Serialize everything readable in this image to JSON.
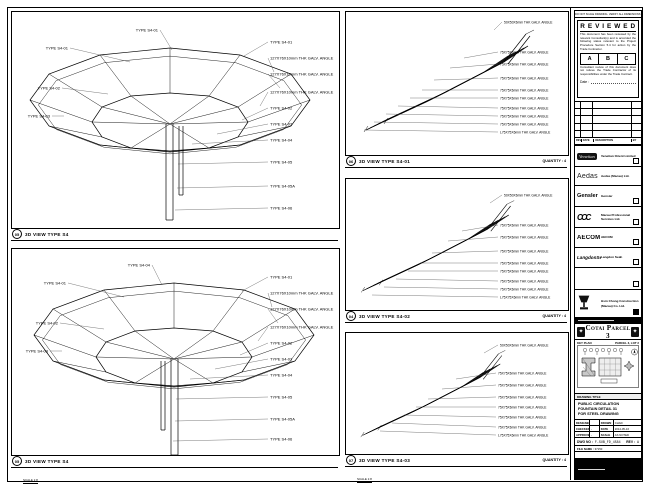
{
  "panels": [
    {
      "key": "tl",
      "num": "05",
      "title": "3D VIEW TYPE S4",
      "scale": "SCALE 1:8",
      "quantity": "",
      "callouts": [
        {
          "t": "TYPE S4-01",
          "a": "end",
          "p": [
            [
              160,
              38
            ],
            [
              148,
              18
            ]
          ]
        },
        {
          "t": "TYPE S4-01",
          "a": "end",
          "p": [
            [
              118,
              50
            ],
            [
              58,
              36
            ]
          ]
        },
        {
          "t": "TYPE S4-02",
          "a": "end",
          "p": [
            [
              96,
              82
            ],
            [
              50,
              76
            ]
          ]
        },
        {
          "t": "TYPE S4-03",
          "a": "end",
          "p": [
            [
              52,
              104
            ],
            [
              40,
              104
            ]
          ]
        },
        {
          "t": "TYPE S4-01",
          "a": "start",
          "p": [
            [
              232,
              44
            ],
            [
              256,
              30
            ]
          ]
        },
        {
          "t": "127X76X10mm THK GALV. ANGLE",
          "a": "start",
          "p": [
            [
              262,
              60
            ],
            [
              256,
              46
            ]
          ]
        },
        {
          "t": "127X76X10mm THK GALV. ANGLE",
          "a": "start",
          "p": [
            [
              268,
              76
            ],
            [
              256,
              62
            ]
          ]
        },
        {
          "t": "127X76X10mm THK GALV. ANGLE",
          "a": "start",
          "p": [
            [
              248,
              94
            ],
            [
              256,
              80
            ]
          ]
        },
        {
          "t": "TYPE S4-02",
          "a": "start",
          "p": [
            [
              230,
              108
            ],
            [
              256,
              96
            ]
          ]
        },
        {
          "t": "TYPE S4-03",
          "a": "start",
          "p": [
            [
              205,
              122
            ],
            [
              256,
              112
            ]
          ]
        },
        {
          "t": "TYPE S4-04",
          "a": "start",
          "p": [
            [
              180,
              132
            ],
            [
              256,
              128
            ]
          ]
        },
        {
          "t": "TYPE S4-05",
          "a": "start",
          "p": [
            [
              166,
              152
            ],
            [
              256,
              150
            ]
          ]
        },
        {
          "t": "TYPE S4-05A",
          "a": "start",
          "p": [
            [
              165,
              176
            ],
            [
              256,
              174
            ]
          ]
        },
        {
          "t": "TYPE S4-06",
          "a": "start",
          "p": [
            [
              163,
              198
            ],
            [
              256,
              196
            ]
          ]
        }
      ]
    },
    {
      "key": "bl",
      "num": "05",
      "title": "3D VIEW TYPE S4",
      "scale": "SCALE 1:8",
      "quantity": "",
      "callouts": [
        {
          "t": "TYPE S4-04",
          "a": "end",
          "p": [
            [
              150,
              36
            ],
            [
              140,
              16
            ]
          ]
        },
        {
          "t": "TYPE S4-01",
          "a": "end",
          "p": [
            [
              112,
              48
            ],
            [
              56,
              34
            ]
          ]
        },
        {
          "t": "TYPE S4-02",
          "a": "end",
          "p": [
            [
              92,
              80
            ],
            [
              48,
              74
            ]
          ]
        },
        {
          "t": "TYPE S4-03",
          "a": "end",
          "p": [
            [
              50,
              102
            ],
            [
              38,
              102
            ]
          ]
        },
        {
          "t": "TYPE S4-01",
          "a": "start",
          "p": [
            [
              230,
              42
            ],
            [
              256,
              28
            ]
          ]
        },
        {
          "t": "127X76X10mm THK GALV. ANGLE",
          "a": "start",
          "p": [
            [
              260,
              58
            ],
            [
              256,
              44
            ]
          ]
        },
        {
          "t": "127X76X10mm THK GALV. ANGLE",
          "a": "start",
          "p": [
            [
              266,
              74
            ],
            [
              256,
              60
            ]
          ]
        },
        {
          "t": "127X76X10mm THK GALV. ANGLE",
          "a": "start",
          "p": [
            [
              246,
              92
            ],
            [
              256,
              78
            ]
          ]
        },
        {
          "t": "TYPE S4-02",
          "a": "start",
          "p": [
            [
              228,
              106
            ],
            [
              256,
              94
            ]
          ]
        },
        {
          "t": "TYPE S4-03",
          "a": "start",
          "p": [
            [
              203,
              120
            ],
            [
              256,
              110
            ]
          ]
        },
        {
          "t": "TYPE S4-04",
          "a": "start",
          "p": [
            [
              178,
              130
            ],
            [
              256,
              126
            ]
          ]
        },
        {
          "t": "TYPE S4-05",
          "a": "start",
          "p": [
            [
              164,
              150
            ],
            [
              256,
              148
            ]
          ]
        },
        {
          "t": "TYPE S4-05A",
          "a": "start",
          "p": [
            [
              163,
              172
            ],
            [
              256,
              170
            ]
          ]
        },
        {
          "t": "TYPE S4-06",
          "a": "start",
          "p": [
            [
              161,
              192
            ],
            [
              256,
              190
            ]
          ]
        }
      ]
    },
    {
      "key": "m1",
      "num": "06",
      "title": "3D VIEW TYPE S4-01",
      "scale": "SCALE 1:8",
      "quantity": "QUANTITY : 4",
      "callouts": [
        {
          "t": "50X50X6mm THK GALV. ANGLE",
          "a": "start",
          "p": [
            [
              148,
              18
            ],
            [
              156,
              10
            ]
          ]
        },
        {
          "t": "75X75X6mm THK GALV. ANGLE",
          "a": "start",
          "p": [
            [
              118,
              46
            ],
            [
              152,
              40
            ]
          ]
        },
        {
          "t": "75X75X6mm THK GALV. ANGLE",
          "a": "start",
          "p": [
            [
              104,
              56
            ],
            [
              152,
              52
            ]
          ]
        },
        {
          "t": "75X75X6mm THK GALV. ANGLE",
          "a": "start",
          "p": [
            [
              88,
              68
            ],
            [
              152,
              66
            ]
          ]
        },
        {
          "t": "75X75X6mm THK GALV. ANGLE",
          "a": "start",
          "p": [
            [
              76,
              78
            ],
            [
              152,
              78
            ]
          ]
        },
        {
          "t": "75X75X6mm THK GALV. ANGLE",
          "a": "start",
          "p": [
            [
              64,
              86
            ],
            [
              152,
              86
            ]
          ]
        },
        {
          "t": "75X75X6mm THK GALV. ANGLE",
          "a": "start",
          "p": [
            [
              52,
              94
            ],
            [
              152,
              96
            ]
          ]
        },
        {
          "t": "75X75X6mm THK GALV. ANGLE",
          "a": "start",
          "p": [
            [
              40,
              102
            ],
            [
              152,
              104
            ]
          ]
        },
        {
          "t": "75X75X6mm THK GALV. ANGLE",
          "a": "start",
          "p": [
            [
              28,
              110
            ],
            [
              152,
              112
            ]
          ]
        },
        {
          "t": "L75X75X6mm THK GALV. ANGLE",
          "a": "start",
          "p": [
            [
              18,
              118
            ],
            [
              152,
              120
            ]
          ]
        }
      ]
    },
    {
      "key": "m2",
      "num": "04",
      "title": "3D VIEW TYPE S4-02",
      "scale": "SCALE 1:8",
      "quantity": "QUANTITY : 4",
      "callouts": [
        {
          "t": "50X50X6mm THK GALV. ANGLE",
          "a": "start",
          "p": [
            [
              144,
              24
            ],
            [
              156,
              16
            ]
          ]
        },
        {
          "t": "75X75X6mm THK GALV. ANGLE",
          "a": "start",
          "p": [
            [
              116,
              52
            ],
            [
              152,
              46
            ]
          ]
        },
        {
          "t": "75X75X6mm THK GALV. ANGLE",
          "a": "start",
          "p": [
            [
              102,
              62
            ],
            [
              152,
              58
            ]
          ]
        },
        {
          "t": "75X75X6mm THK GALV. ANGLE",
          "a": "start",
          "p": [
            [
              86,
              74
            ],
            [
              152,
              72
            ]
          ]
        },
        {
          "t": "75X75X6mm THK GALV. ANGLE",
          "a": "start",
          "p": [
            [
              74,
              84
            ],
            [
              152,
              84
            ]
          ]
        },
        {
          "t": "75X75X6mm THK GALV. ANGLE",
          "a": "start",
          "p": [
            [
              62,
              92
            ],
            [
              152,
              92
            ]
          ]
        },
        {
          "t": "75X75X6mm THK GALV. ANGLE",
          "a": "start",
          "p": [
            [
              50,
              100
            ],
            [
              152,
              102
            ]
          ]
        },
        {
          "t": "75X75X6mm THK GALV. ANGLE",
          "a": "start",
          "p": [
            [
              38,
              108
            ],
            [
              152,
              110
            ]
          ]
        },
        {
          "t": "L75X75X6mm THK GALV. ANGLE",
          "a": "start",
          "p": [
            [
              26,
              116
            ],
            [
              152,
              118
            ]
          ]
        }
      ]
    },
    {
      "key": "m3",
      "num": "07",
      "title": "3D VIEW TYPE S4-03",
      "scale": "SCALE 1:8",
      "quantity": "QUANTITY : 4",
      "callouts": [
        {
          "t": "50X50X6mm THK GALV. ANGLE",
          "a": "start",
          "p": [
            [
              138,
              20
            ],
            [
              152,
              12
            ]
          ]
        },
        {
          "t": "75X75X6mm THK GALV. ANGLE",
          "a": "start",
          "p": [
            [
              110,
              46
            ],
            [
              150,
              40
            ]
          ]
        },
        {
          "t": "75X75X6mm THK GALV. ANGLE",
          "a": "start",
          "p": [
            [
              96,
              56
            ],
            [
              150,
              52
            ]
          ]
        },
        {
          "t": "75X75X6mm THK GALV. ANGLE",
          "a": "start",
          "p": [
            [
              82,
              66
            ],
            [
              150,
              64
            ]
          ]
        },
        {
          "t": "75X75X6mm THK GALV. ANGLE",
          "a": "start",
          "p": [
            [
              70,
              74
            ],
            [
              150,
              74
            ]
          ]
        },
        {
          "t": "75X75X6mm THK GALV. ANGLE",
          "a": "start",
          "p": [
            [
              58,
              82
            ],
            [
              150,
              84
            ]
          ]
        },
        {
          "t": "75X75X6mm THK GALV. ANGLE",
          "a": "start",
          "p": [
            [
              46,
              90
            ],
            [
              150,
              94
            ]
          ]
        },
        {
          "t": "L75X75X6mm THK GALV. ANGLE",
          "a": "start",
          "p": [
            [
              34,
              98
            ],
            [
              150,
              102
            ]
          ]
        }
      ]
    }
  ],
  "stamp": {
    "note": "DO NOT SCALE DRAWING. VERIFY ALL DIMENSIONS ON SITE.",
    "title": "R E V I E W E D",
    "para1": "This document has been reviewed by the relevant Consultant(s) and is accorded the following status relevant to the Project Procedure Section 5.4 for action by the Trade Contractor.",
    "grades": [
      "A",
      "B",
      "C"
    ],
    "para2": "Consultant review of this document does not relieve the Trade Contractor of its responsibilities under the Trade Contract.",
    "date_label": "Date :"
  },
  "rev_table": {
    "headers": [
      "REV",
      "DATE",
      "DESCRIPTION",
      "BY"
    ]
  },
  "consultants": [
    {
      "logo": "Venetian",
      "name": "Venetian Orient Limited"
    },
    {
      "logo": "Aedas",
      "name": "Aedas (Macau) Ltd."
    },
    {
      "logo": "Gensler",
      "name": "Gensler"
    },
    {
      "logo": "CCC",
      "name": "Macau Professional Services Ltd."
    },
    {
      "logo": "AECOM",
      "name": "AECOM"
    },
    {
      "logo": "LangdonSeah",
      "name": "Langdon Seah"
    }
  ],
  "contractor": {
    "name": "Hsin Chong Construction (Macau) Co. Ltd."
  },
  "project": {
    "banner": "Cotai Parcel 3",
    "keyplan_label": "KEY PLAN",
    "parcel_label": "PARCEL 3, LOT 2"
  },
  "titleblock": {
    "header": "DRAWING TITLE",
    "line1": "PUBLIC CIRCULATION",
    "line2": "FOUNTAIN DETAIL 31",
    "line3": "FOR STEEL DRAWING",
    "f_designed": "DESIGNED",
    "f_checked": "CHECKED",
    "f_approved": "APPROVED",
    "f_drawn": "DRAWN",
    "f_date": "DATE",
    "f_scale": "SCALE",
    "v_dash1": "-",
    "v_dash2": "-",
    "v_drawn": "CHAD",
    "v_date": "2014-05-16",
    "v_scale": "AS NOTED",
    "dwg_label": "DWG NO :",
    "dwg_no": "F-SUB_FD_4584",
    "rev_label": "REV :",
    "rev": "A",
    "file_label": "FILE NAME :",
    "file": "37150"
  }
}
